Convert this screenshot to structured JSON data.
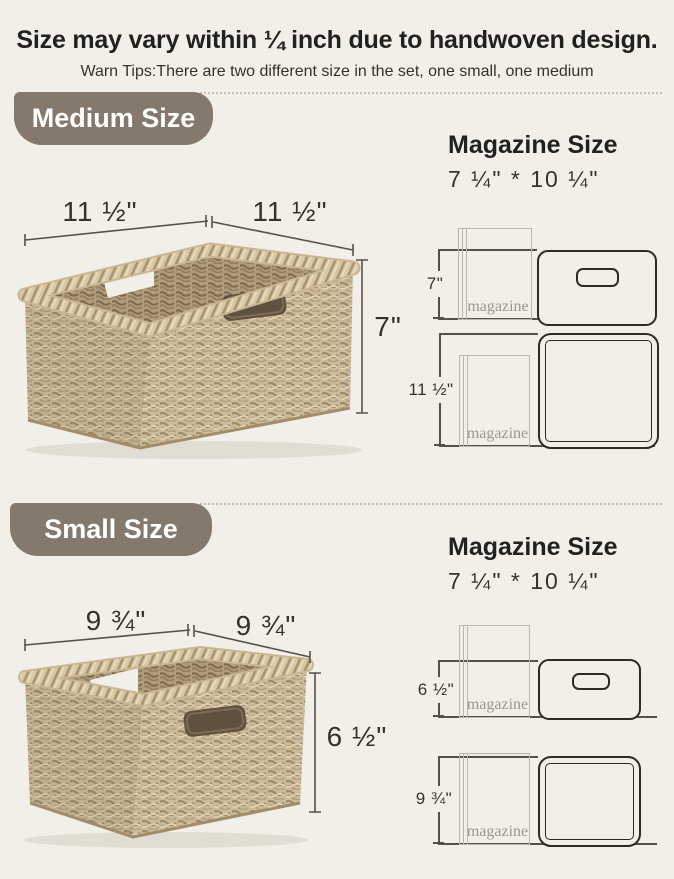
{
  "page": {
    "title": "Size may vary within ¼ inch due to handwoven design.",
    "subtitle": "Warn Tips:There are two different size in the set, one small, one medium"
  },
  "colors": {
    "background": "#f2efe9",
    "badge_background": "#84796c",
    "badge_text": "#ffffff",
    "heading_text": "#23211d",
    "body_text": "#35322e",
    "outline_dark": "#2e2b27",
    "outline_light": "#bcb7ae",
    "dim_line": "#56504a",
    "magazine_label_text": "#9d978d",
    "basket_tan": "#cbbb9c",
    "basket_rim": "#d7c8a8"
  },
  "sections": [
    {
      "id": "medium",
      "badge_label": "Medium Size",
      "basket_dims": {
        "top_left": "11 ½\"",
        "top_right": "11 ½\"",
        "height": "7\""
      },
      "magazine_panel": {
        "heading": "Magazine Size",
        "size_text": "7 ¼\" * 10 ¼\"",
        "front_view": {
          "dim_label": "7\"",
          "magazine_label": "magazine"
        },
        "top_view": {
          "dim_label": "11 ½\"",
          "magazine_label": "magazine"
        }
      }
    },
    {
      "id": "small",
      "badge_label": "Small Size",
      "basket_dims": {
        "top_left": "9 ¾\"",
        "top_right": "9 ¾\"",
        "height": "6 ½\""
      },
      "magazine_panel": {
        "heading": "Magazine Size",
        "size_text": "7 ¼\" * 10 ¼\"",
        "front_view": {
          "dim_label": "6 ½\"",
          "magazine_label": "magazine"
        },
        "top_view": {
          "dim_label": "9 ¾\"",
          "magazine_label": "magazine"
        }
      }
    }
  ]
}
